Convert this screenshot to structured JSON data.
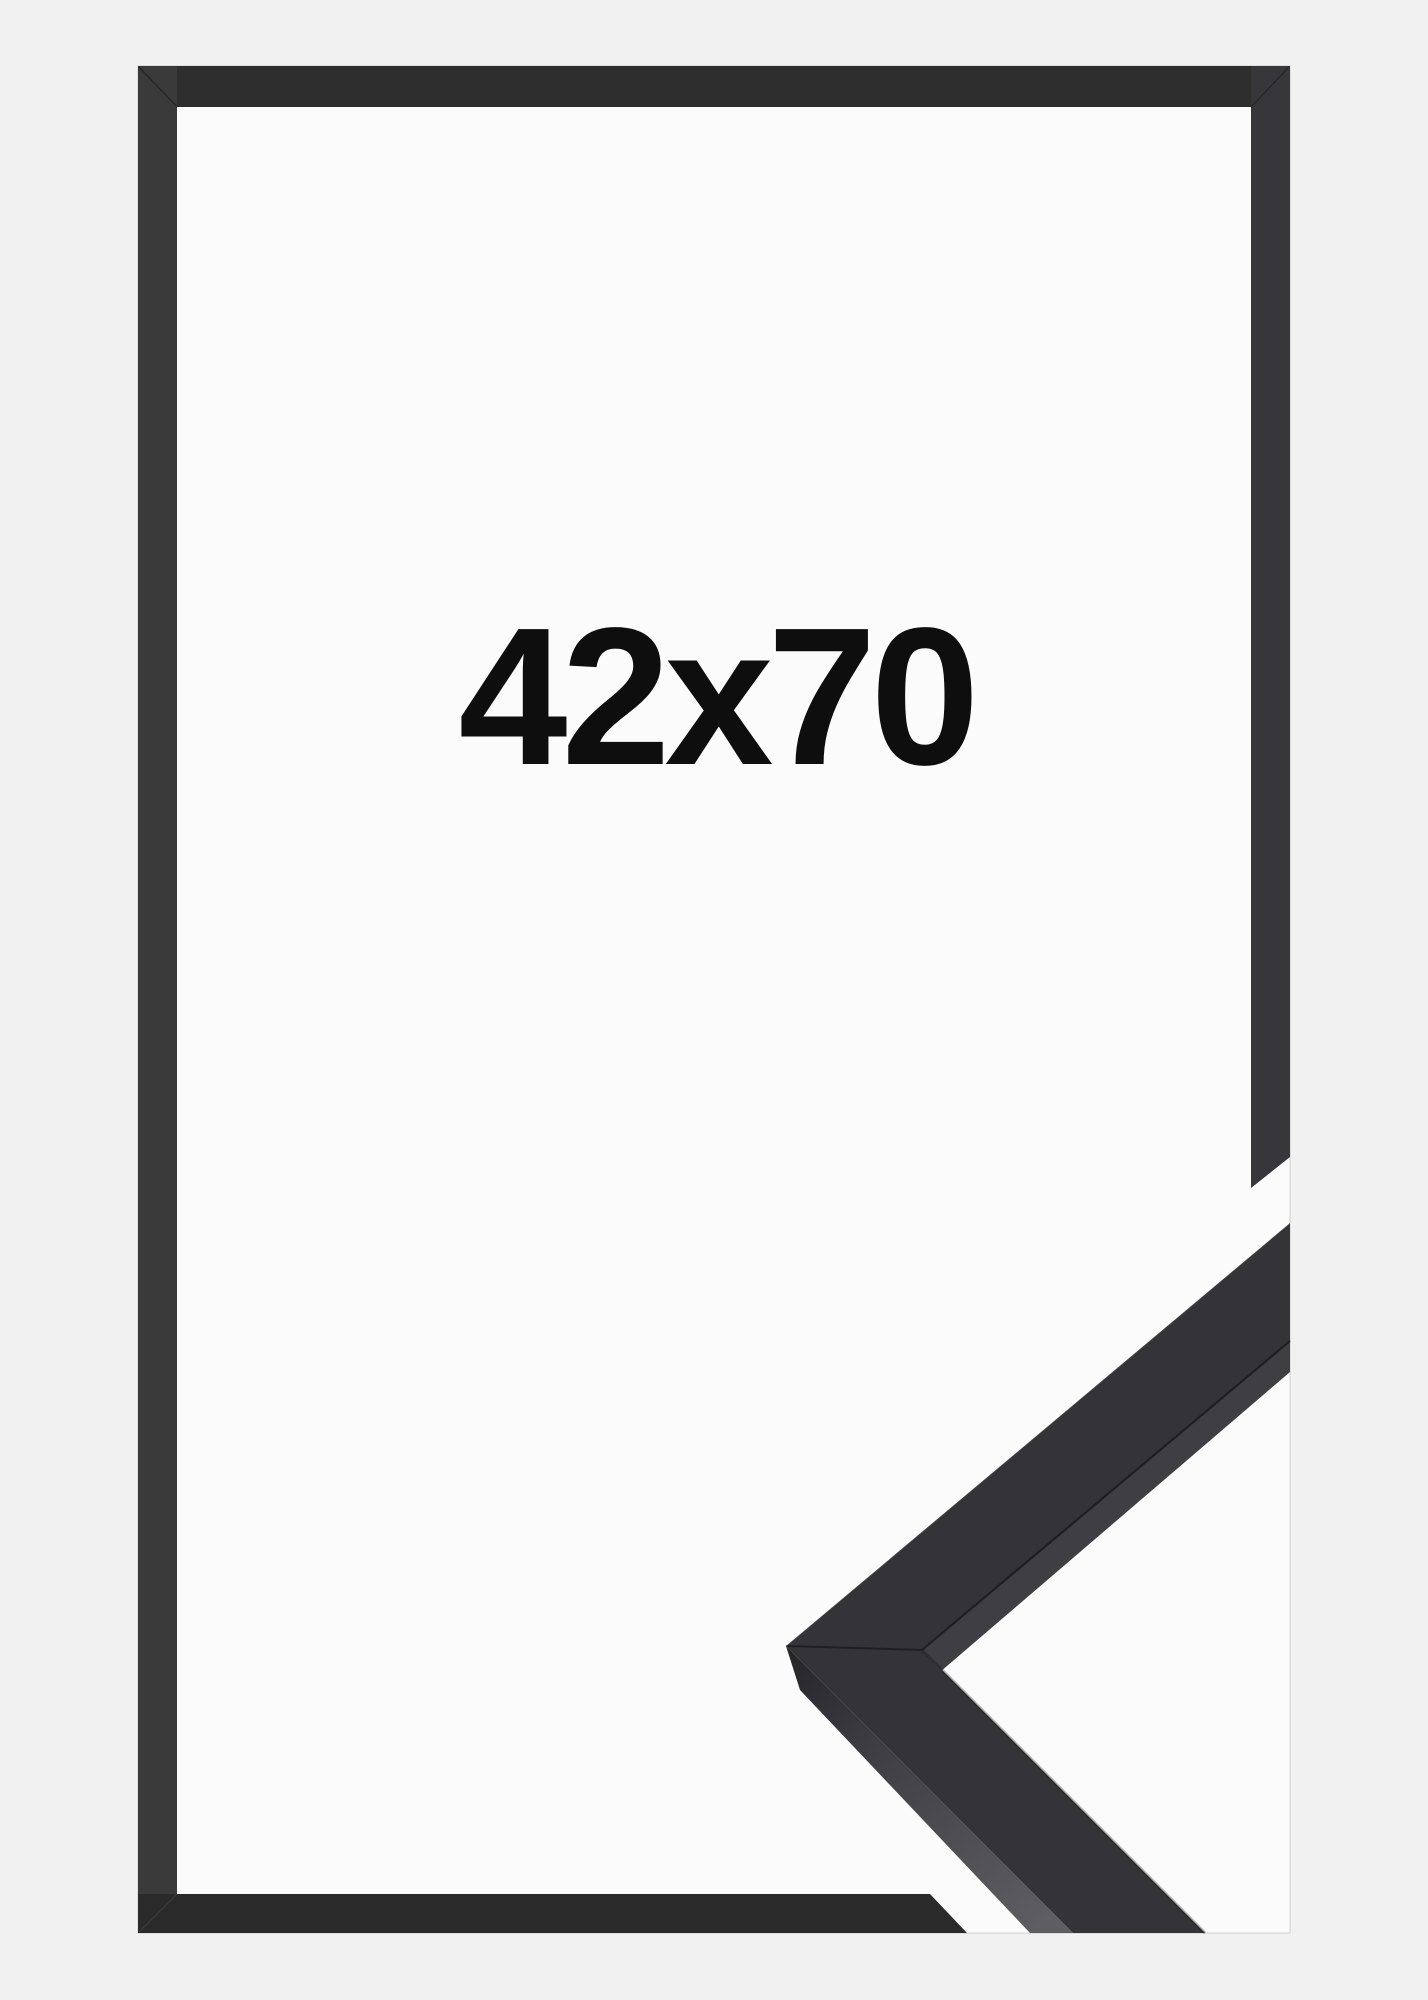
{
  "page": {
    "background_color": "#f1f1f2"
  },
  "product_photo": {
    "size_label": "42x70",
    "colors": {
      "backing": "#fbfbfb",
      "frame_top": "#2e2e2e",
      "frame_left": "#3a3a3a",
      "frame_right": "#37373b",
      "frame_bottom": "#2a2a2a",
      "sample_front": "#343438",
      "sample_inner_edge": "#3e3e43",
      "label_text": "#0e0e0e"
    }
  }
}
